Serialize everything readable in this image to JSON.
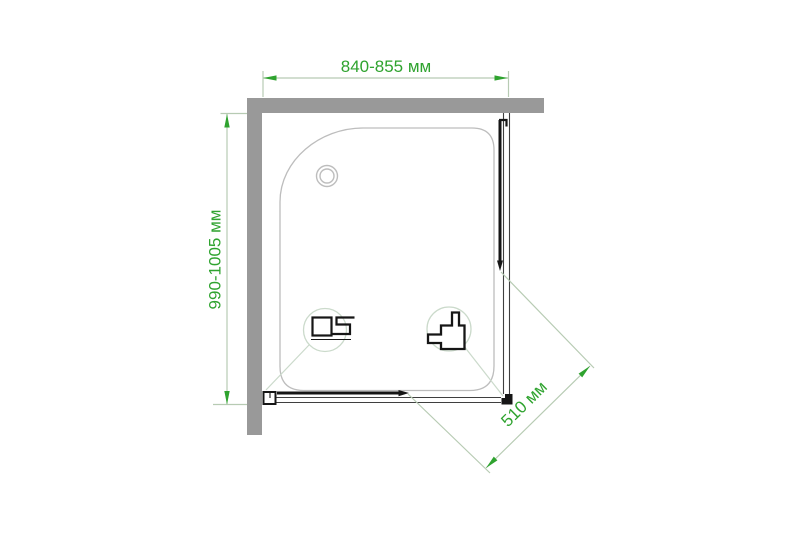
{
  "colors": {
    "background": "#ffffff",
    "wall_gray": "#999999",
    "tray_outline": "#bdbdbd",
    "profile_dark": "#161616",
    "track_line": "#3f3f3f",
    "dimension_green": "#2fa32f",
    "dimension_line_pale": "#b7cbb3",
    "callout_stroke": "#cbdacb"
  },
  "diagram": {
    "type": "shower-enclosure-plan-view",
    "unit": "мм",
    "dimensions": {
      "width": {
        "label": "840-855 мм",
        "min_mm": 840,
        "max_mm": 855
      },
      "depth": {
        "label": "990-1005 мм",
        "min_mm": 990,
        "max_mm": 1005
      },
      "door_opening": {
        "label": "510 мм",
        "value_mm": 510
      }
    },
    "icons": [
      "wall-icon",
      "drain-icon",
      "bottom-rail-profile-icon",
      "wall-profile-icon",
      "door-slide-arrow-icon"
    ]
  }
}
